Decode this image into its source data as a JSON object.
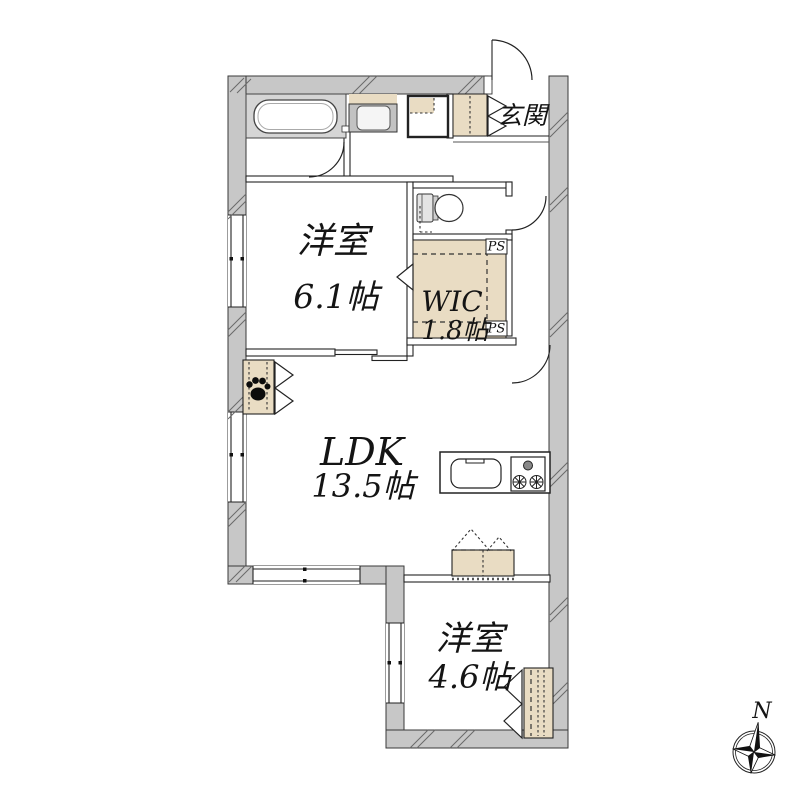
{
  "floor_plan": {
    "entrance_label": "玄関",
    "rooms": [
      {
        "name": "洋室",
        "size": "6.1帖"
      },
      {
        "name": "WIC",
        "size": "1.8帖"
      },
      {
        "name": "LDK",
        "size": "13.5帖"
      },
      {
        "name": "洋室",
        "size": "4.6帖"
      }
    ],
    "pipe_spaces": [
      "PS",
      "PS"
    ],
    "compass": {
      "north_label": "N"
    },
    "fixtures": [
      "bathtub",
      "washing-machine",
      "washbasin",
      "toilet",
      "shoe-cabinet",
      "kitchen-sink",
      "gas-stove",
      "pet-storage",
      "storage-counter",
      "closet"
    ],
    "colors": {
      "background": "#ffffff",
      "wall_gray": "#c7c7c7",
      "bath_gray": "#d5d5d5",
      "storage_beige": "#e9dcc3",
      "line": "#222222"
    }
  }
}
